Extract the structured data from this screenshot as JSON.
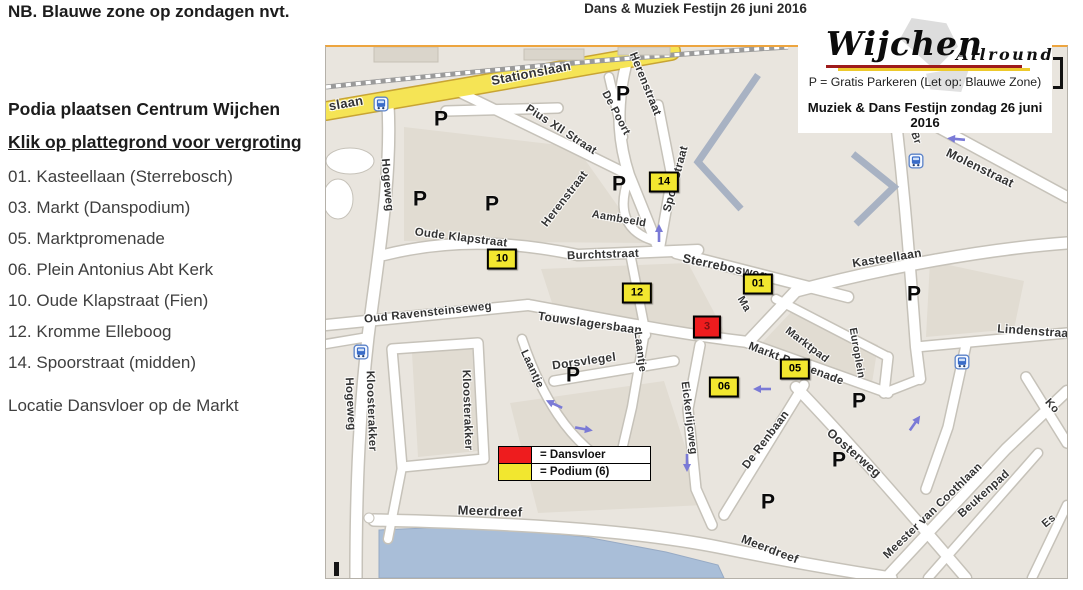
{
  "page": {
    "note": "NB. Blauwe zone op zondagen nvt.",
    "map_title": "Dans & Muziek Festijn 26 juni 2016"
  },
  "sidebar": {
    "heading": "Podia plaatsen Centrum Wijchen",
    "link": "Klik op plattegrond voor vergroting",
    "items": [
      "01. Kasteellaan (Sterrebosch)",
      "03. Markt (Danspodium)",
      "05. Marktpromenade",
      "06. Plein Antonius Abt Kerk",
      "10. Oude Klapstraat (Fien)",
      "12. Kromme Elleboog",
      "14. Spoorstraat (midden)"
    ],
    "footer": "Locatie Dansvloer op de Markt"
  },
  "map": {
    "overlay": {
      "logo_main": "Wijchen",
      "logo_sub": "Allround",
      "parking_note": "P = Gratis Parkeren (Let op: Blauwe Zone)",
      "event_line": "Muziek & Dans Festijn zondag 26 juni 2016"
    },
    "colors": {
      "dansvloer": "#ee1c1e",
      "podium": "#f2e72f"
    },
    "legend": [
      {
        "swatch": "dansvloer",
        "label": "= Dansvloer"
      },
      {
        "swatch": "podium",
        "label": "= Podium (6)"
      }
    ],
    "parking_letter": "P",
    "markers": [
      {
        "label": "14",
        "type": "podium",
        "x": 338,
        "y": 135
      },
      {
        "label": "10",
        "type": "podium",
        "x": 176,
        "y": 212
      },
      {
        "label": "12",
        "type": "podium",
        "x": 311,
        "y": 246
      },
      {
        "label": "01",
        "type": "podium",
        "x": 432,
        "y": 237
      },
      {
        "label": "3",
        "type": "dansvloer",
        "x": 381,
        "y": 280
      },
      {
        "label": "05",
        "type": "podium",
        "x": 469,
        "y": 322
      },
      {
        "label": "06",
        "type": "podium",
        "x": 398,
        "y": 340
      }
    ],
    "parking": [
      {
        "x": 115,
        "y": 72
      },
      {
        "x": 94,
        "y": 152
      },
      {
        "x": 166,
        "y": 157
      },
      {
        "x": 297,
        "y": 47
      },
      {
        "x": 293,
        "y": 137
      },
      {
        "x": 588,
        "y": 247
      },
      {
        "x": 533,
        "y": 354
      },
      {
        "x": 513,
        "y": 413
      },
      {
        "x": 442,
        "y": 455
      },
      {
        "x": 247,
        "y": 328
      }
    ],
    "bus_stops": [
      {
        "x": 55,
        "y": 57
      },
      {
        "x": 590,
        "y": 114
      },
      {
        "x": 35,
        "y": 305
      },
      {
        "x": 636,
        "y": 315
      }
    ],
    "arrows": [
      {
        "x": 333,
        "y": 186,
        "r": -90
      },
      {
        "x": 228,
        "y": 357,
        "r": 205
      },
      {
        "x": 258,
        "y": 382,
        "r": 10
      },
      {
        "x": 436,
        "y": 342,
        "r": 180
      },
      {
        "x": 589,
        "y": 376,
        "r": -55
      },
      {
        "x": 630,
        "y": 92,
        "r": 185
      },
      {
        "x": 361,
        "y": 416,
        "r": 90
      }
    ],
    "streets": [
      {
        "t": "Stationslaan",
        "x": 205,
        "y": 26,
        "r": -11,
        "s": 13
      },
      {
        "t": "slaan",
        "x": 20,
        "y": 56,
        "r": -10,
        "s": 13
      },
      {
        "t": "Hogeweg",
        "x": 61,
        "y": 138,
        "r": 85,
        "s": 11.5
      },
      {
        "t": "Hogeweg",
        "x": 24,
        "y": 357,
        "r": 87,
        "s": 11.5
      },
      {
        "t": "Pius XII Straat",
        "x": 235,
        "y": 83,
        "r": 33,
        "s": 11.5
      },
      {
        "t": "De Poort",
        "x": 290,
        "y": 66,
        "r": 62,
        "s": 11
      },
      {
        "t": "Herenstraat",
        "x": 319,
        "y": 37,
        "r": 68,
        "s": 11.5
      },
      {
        "t": "Herenstraat",
        "x": 239,
        "y": 152,
        "r": -52,
        "s": 11.5
      },
      {
        "t": "Spoorstraat",
        "x": 350,
        "y": 132,
        "r": -75,
        "s": 11.5
      },
      {
        "t": "Aambeeld",
        "x": 293,
        "y": 172,
        "r": 10,
        "s": 11
      },
      {
        "t": "Oude Klapstraat",
        "x": 135,
        "y": 191,
        "r": 7,
        "s": 11.5
      },
      {
        "t": "Burchtstraat",
        "x": 277,
        "y": 208,
        "r": -2,
        "s": 11.5
      },
      {
        "t": "Sterrebosweg",
        "x": 399,
        "y": 220,
        "r": 12,
        "s": 12.5
      },
      {
        "t": "Kasteellaan",
        "x": 561,
        "y": 211,
        "r": -9,
        "s": 12
      },
      {
        "t": "Molenstraat",
        "x": 654,
        "y": 121,
        "r": 26,
        "s": 12.5
      },
      {
        "t": "Lindenstraat",
        "x": 709,
        "y": 284,
        "r": 4,
        "s": 12
      },
      {
        "t": "Oud Ravensteinseweg",
        "x": 102,
        "y": 266,
        "r": -6,
        "s": 11.5
      },
      {
        "t": "Touwslagersbaan",
        "x": 264,
        "y": 276,
        "r": 8,
        "s": 12
      },
      {
        "t": "Markt Promenade",
        "x": 470,
        "y": 317,
        "r": 21,
        "s": 11.5
      },
      {
        "t": "Marktpad",
        "x": 481,
        "y": 298,
        "r": 37,
        "s": 11
      },
      {
        "t": "Ma",
        "x": 418,
        "y": 257,
        "r": 60,
        "s": 11
      },
      {
        "t": "Europlein",
        "x": 531,
        "y": 306,
        "r": 80,
        "s": 10.5
      },
      {
        "t": "Laantje",
        "x": 206,
        "y": 322,
        "r": 65,
        "s": 11
      },
      {
        "t": "Laantje",
        "x": 314,
        "y": 305,
        "r": 83,
        "s": 11
      },
      {
        "t": "Dorsvlegel",
        "x": 258,
        "y": 314,
        "r": -8,
        "s": 12
      },
      {
        "t": "Kloosterakker",
        "x": 45,
        "y": 364,
        "r": 88,
        "s": 11.5
      },
      {
        "t": "Kloosterakker",
        "x": 141,
        "y": 363,
        "r": 88,
        "s": 11.5
      },
      {
        "t": "Eickerlijcweg",
        "x": 363,
        "y": 371,
        "r": 83,
        "s": 11
      },
      {
        "t": "De Renbaan",
        "x": 440,
        "y": 393,
        "r": -53,
        "s": 11.5
      },
      {
        "t": "Oosterweg",
        "x": 528,
        "y": 406,
        "r": 41,
        "s": 12.5
      },
      {
        "t": "Meester van Coothlaan",
        "x": 607,
        "y": 464,
        "r": -44,
        "s": 11.5
      },
      {
        "t": "Beukenpad",
        "x": 658,
        "y": 447,
        "r": -42,
        "s": 11.5
      },
      {
        "t": "Meerdreef",
        "x": 164,
        "y": 464,
        "r": 2,
        "s": 13
      },
      {
        "t": "Meerdreef",
        "x": 444,
        "y": 502,
        "r": 21,
        "s": 12
      },
      {
        "t": "Ko",
        "x": 726,
        "y": 359,
        "r": 48,
        "s": 11
      },
      {
        "t": "Es",
        "x": 723,
        "y": 474,
        "r": -40,
        "s": 11
      },
      {
        "t": "Br",
        "x": 590,
        "y": 91,
        "r": 70,
        "s": 10.5
      }
    ]
  }
}
